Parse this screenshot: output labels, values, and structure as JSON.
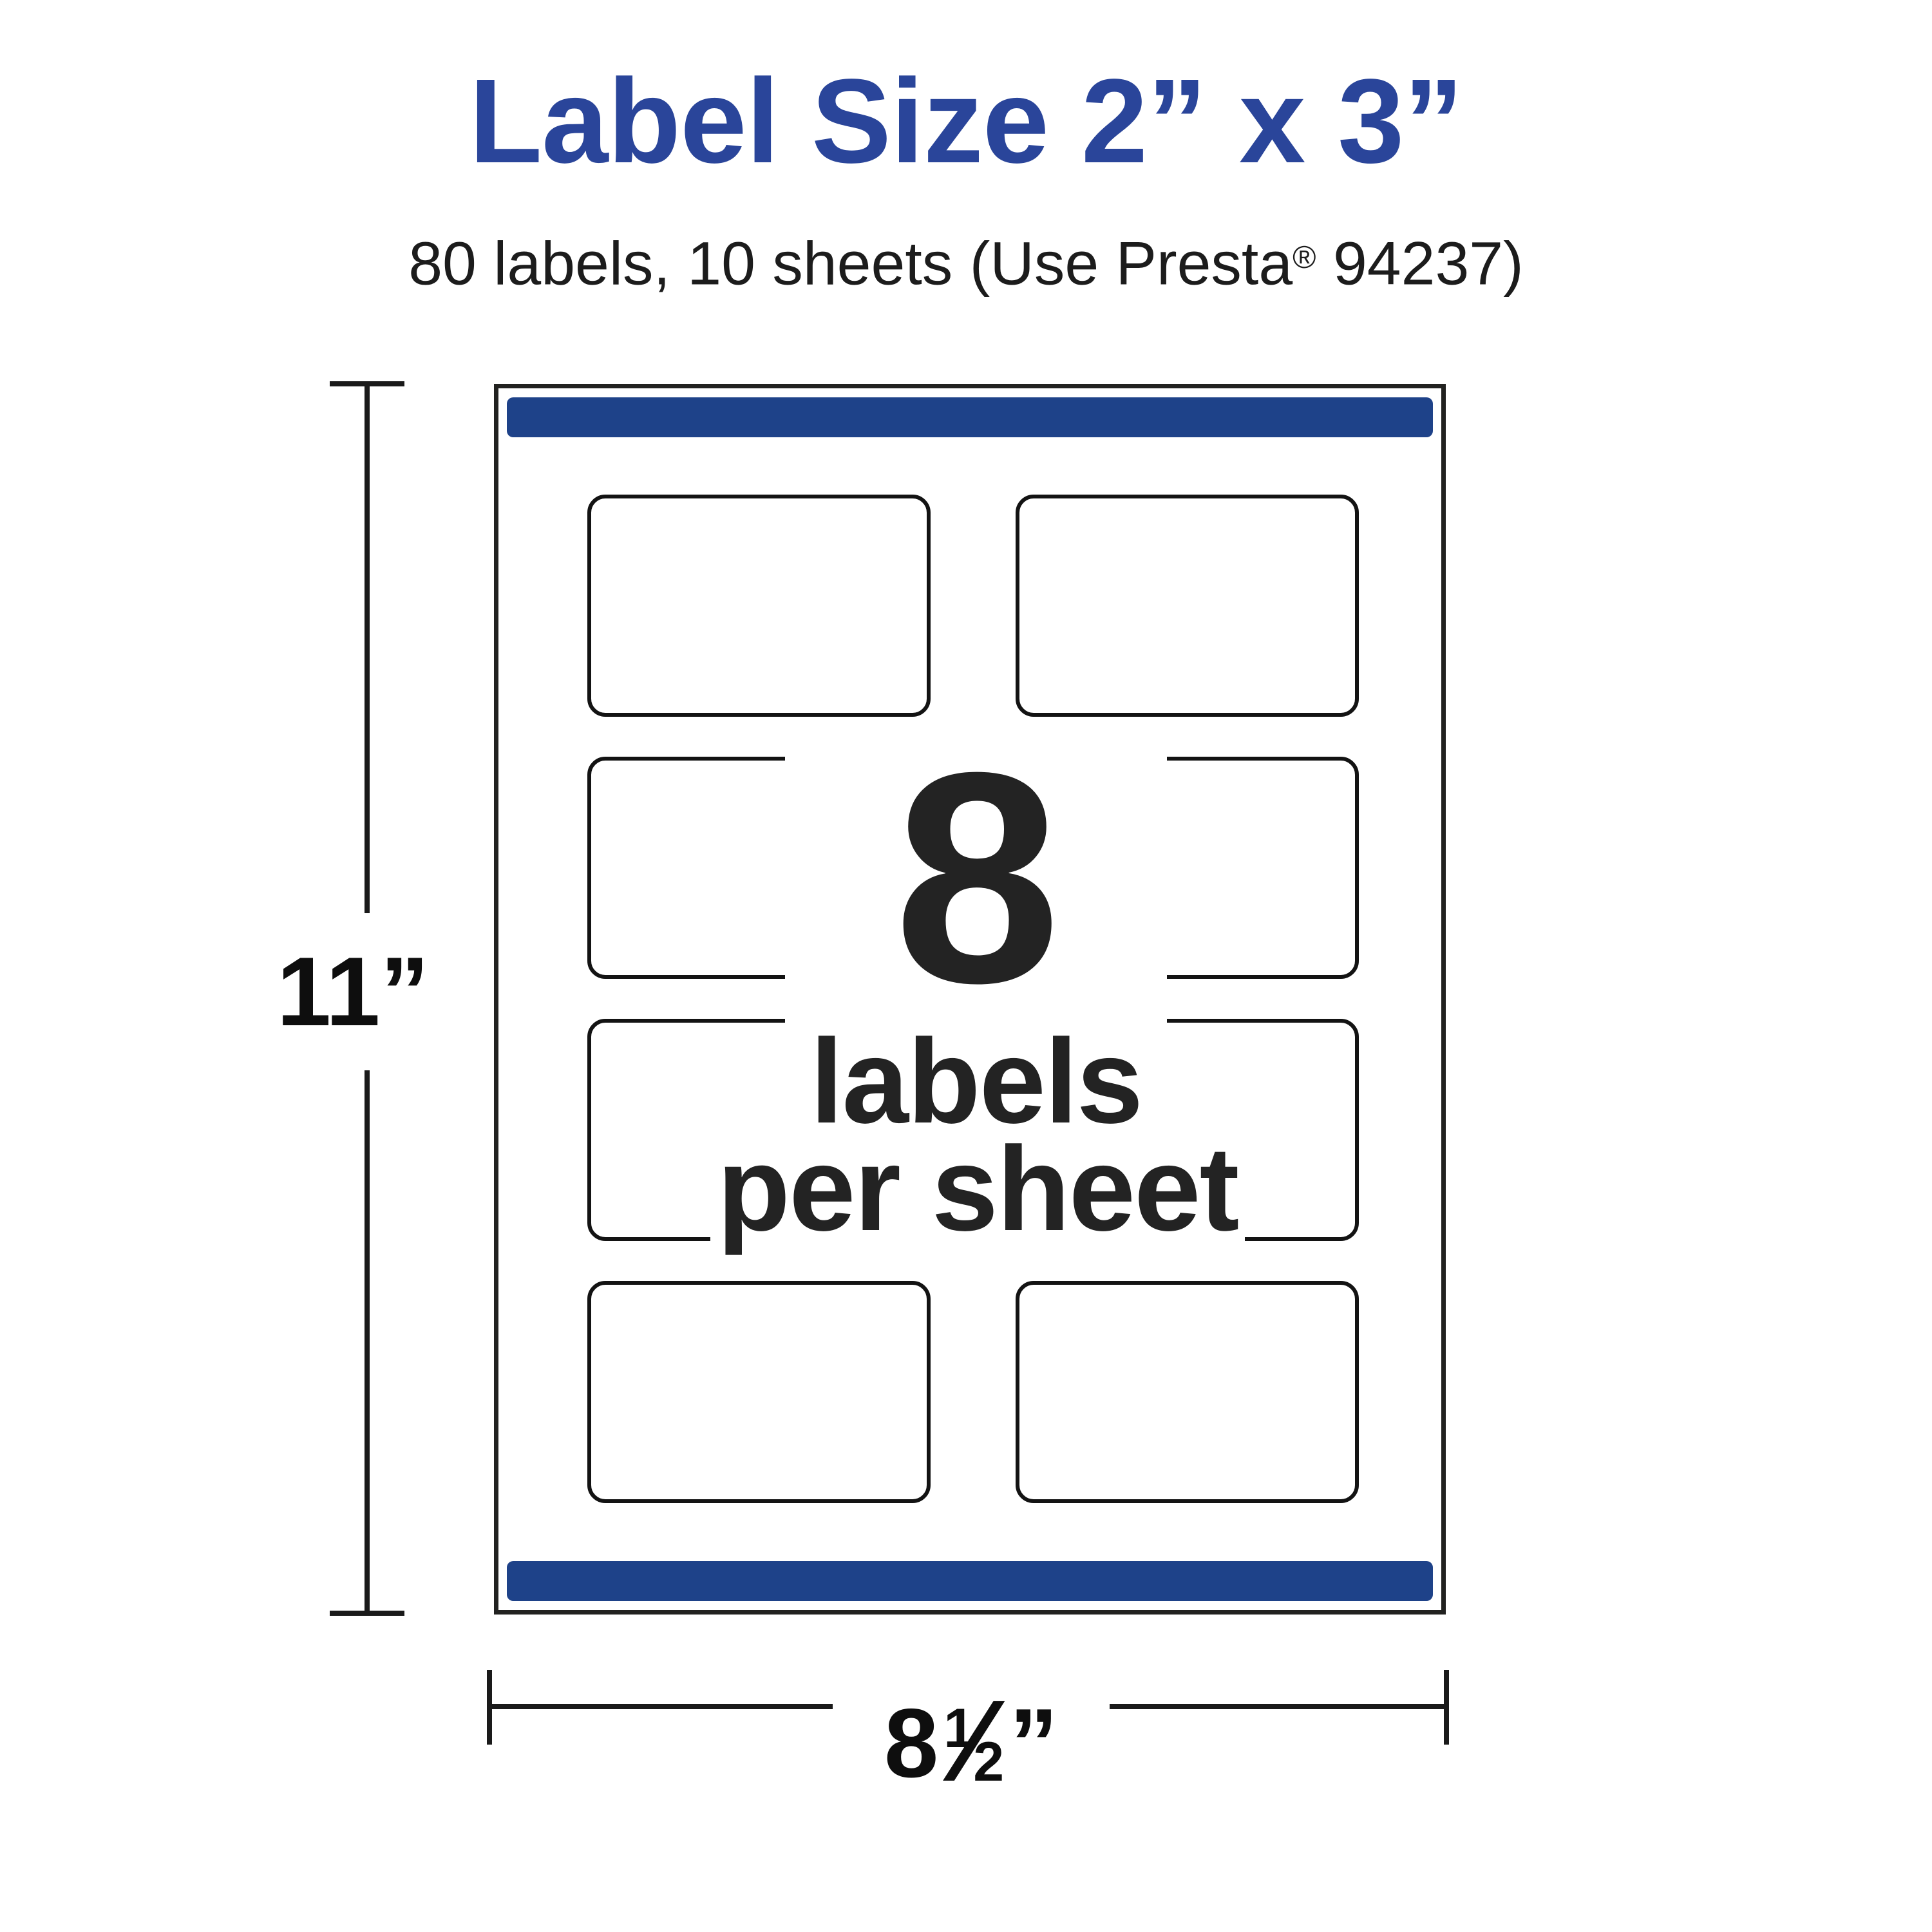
{
  "title": {
    "text": "Label Size 2” x 3”"
  },
  "subtitle": {
    "prefix": "80 labels, 10 sheets (Use Presta",
    "registered": "®",
    "suffix": " 94237)"
  },
  "sheet": {
    "labels_per_sheet": 8,
    "grid": {
      "rows": 4,
      "columns": 2
    },
    "center_callout": {
      "count": "8",
      "line2": "labels",
      "line3": "per sheet"
    }
  },
  "dimensions": {
    "height_label": "11”",
    "width_label": {
      "whole": "8",
      "numerator": "1",
      "slash": "⁄",
      "denominator": "2",
      "unit": "”"
    }
  },
  "colors": {
    "title_blue": "#2A459A",
    "bar_blue": "#1E4289",
    "ink": "#232323",
    "line_black": "#1A1A1A"
  }
}
